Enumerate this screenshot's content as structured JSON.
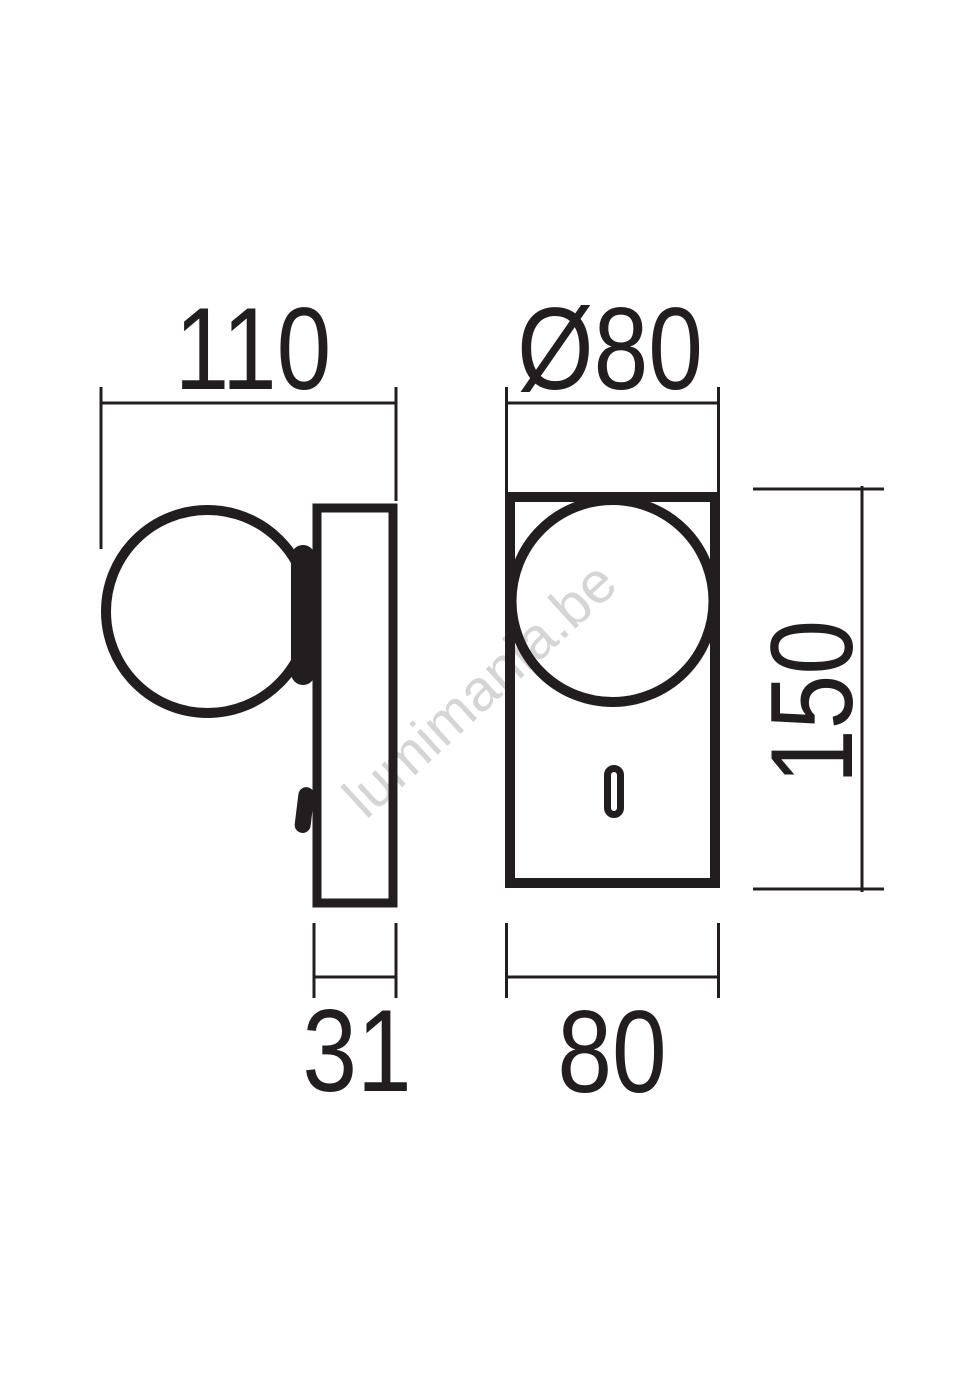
{
  "drawing": {
    "watermark": "lumimania.be",
    "colors": {
      "line": "#221e1f",
      "watermark": "#d5d5d5",
      "background": "#ffffff"
    },
    "dimensions": {
      "overall_width": {
        "label": "110"
      },
      "shade_diameter": {
        "label": "Ø80"
      },
      "body_height": {
        "label": "150"
      },
      "body_depth": {
        "label": "31"
      },
      "body_width": {
        "label": "80"
      }
    }
  }
}
